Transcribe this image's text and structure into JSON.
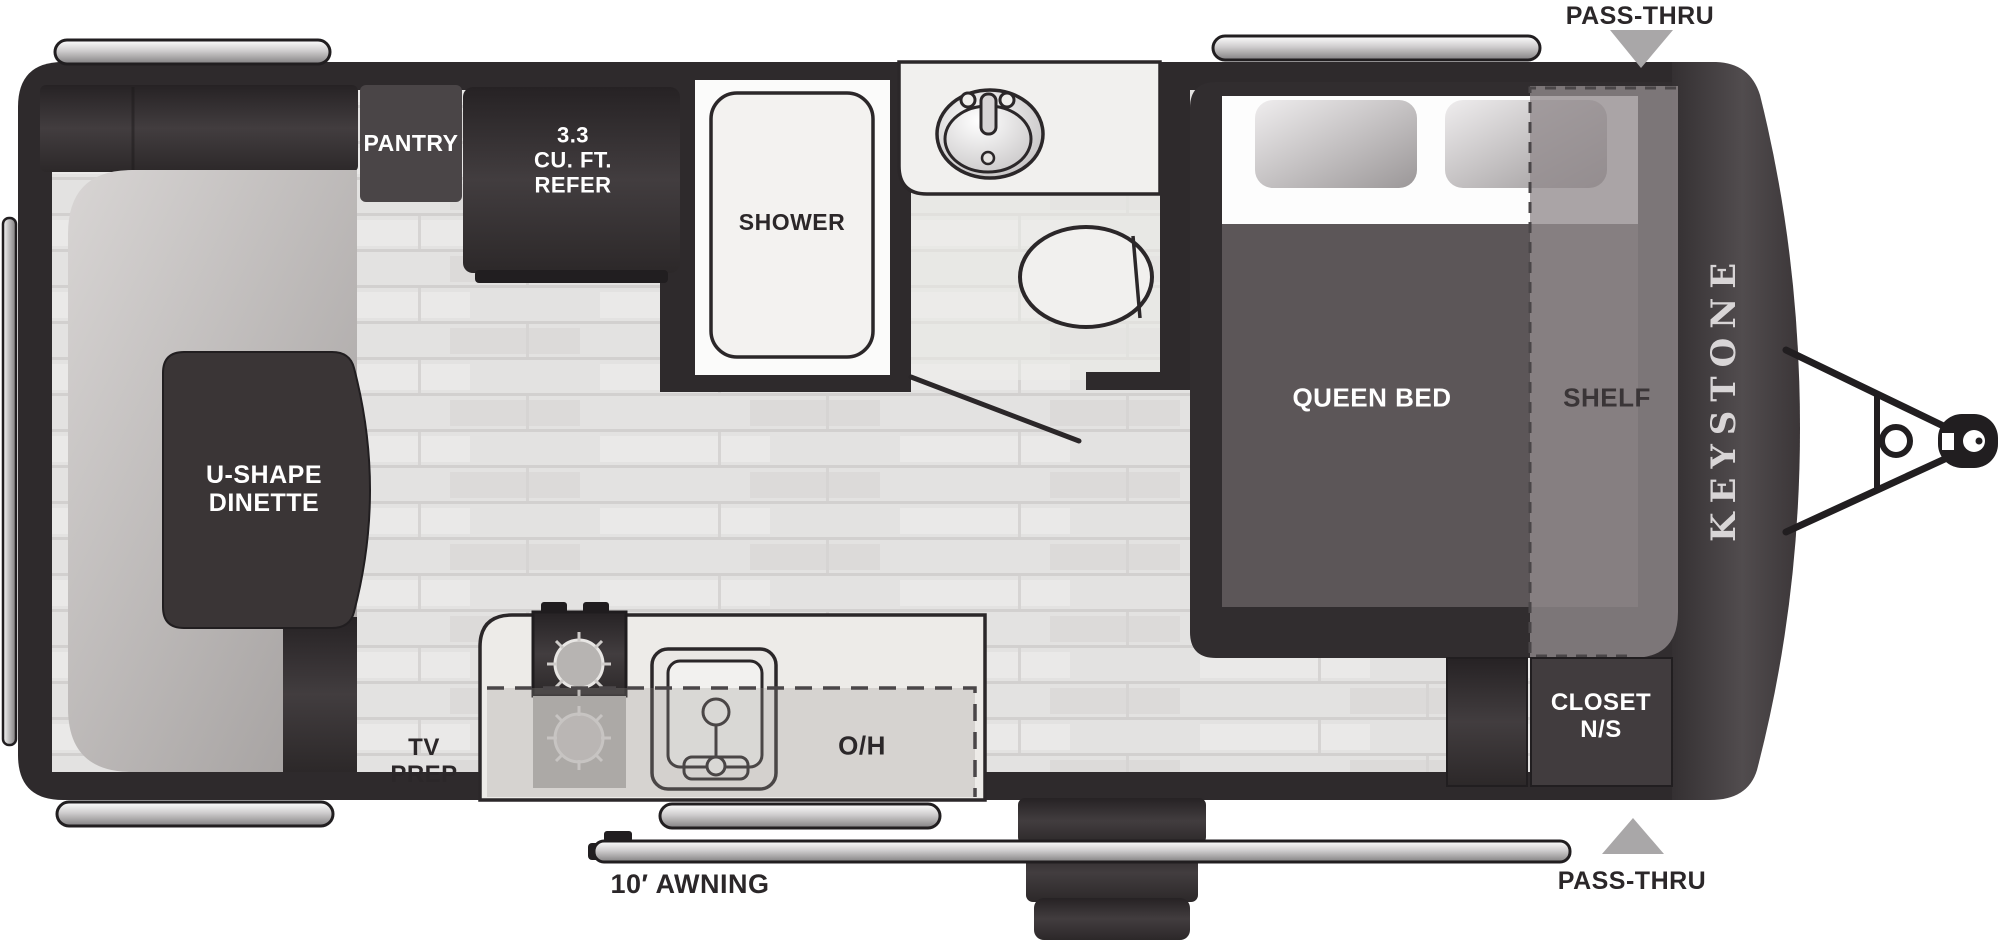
{
  "diagram": {
    "type": "rv-travel-trailer-floorplan",
    "labels": {
      "pantry": "PANTRY",
      "refer": "3.3\nCU. FT.\nREFER",
      "shower": "SHOWER",
      "dinette": "U-SHAPE\nDINETTE",
      "queen_bed": "QUEEN BED",
      "shelf": "SHELF",
      "closet": "CLOSET\nN/S",
      "tv_prep": "TV\nPREP",
      "overhead": "O/H",
      "awning": "10′ AWNING",
      "pass_thru_top": "PASS-THRU",
      "pass_thru_bottom": "PASS-THRU",
      "brand": "KEYSTONE"
    },
    "colors": {
      "wall_dark": "#2e2a2c",
      "furniture_dark": "#3a3537",
      "bed_blanket": "#5c5658",
      "seat_gray": "#c2bfbe",
      "floor_light": "#e3e2e1",
      "silver": "#c9c7c8",
      "arrow_gray": "#a9a7a8",
      "label_white": "#ffffff",
      "label_dark": "#2b2729"
    }
  }
}
